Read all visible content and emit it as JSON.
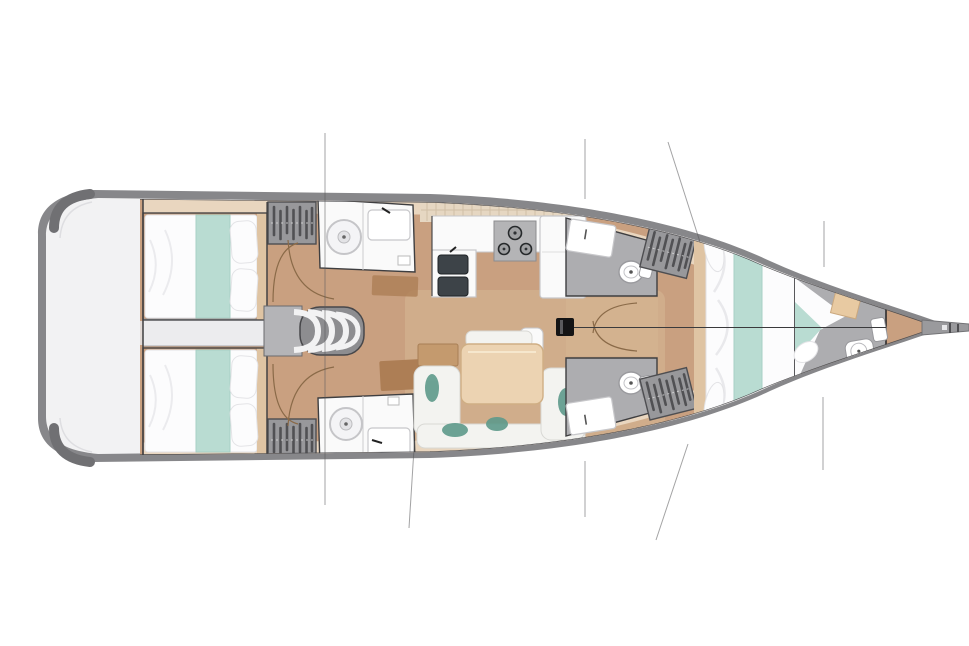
{
  "diagram": {
    "type": "floor-plan",
    "title": "Sailing yacht interior layout plan — top view, bow to the right",
    "areas": {
      "stern_platform": "Stern swim platform",
      "aft_cabin_port": "Aft cabin port side — double berth",
      "aft_cabin_starboard": "Aft cabin starboard side — double berth",
      "corridor": "Aft corridor between cabins",
      "companionway": "Companionway steps",
      "aft_head_port": "Aft head port — shower and sink",
      "aft_head_starboard": "Aft head starboard — shower and sink",
      "chart_table": "Chart table",
      "galley": "Galley — stove, double sink and counters",
      "saloon": "Saloon — U-shaped settee with table",
      "mast": "Mast",
      "fwd_head_port": "Forward head port — toilet and sink",
      "fwd_head_starboard": "Forward head starboard — toilet and sink",
      "fwd_cabin": "Forward cabin — V-berth",
      "forepeak": "Forepeak head compartment",
      "bowsprit": "Bowsprit",
      "wardrobe": "Hanging locker",
      "rigging": "Rigging lines",
      "centerline": "Hull centerline"
    }
  },
  "colors": {
    "hull_edge": "#87878a",
    "hull_corner": "#707073",
    "deck": "#f2f2f3",
    "floor_wood": "#c9a080",
    "floor_wood_light": "#d8b996",
    "side_deck": "#e9d6bf",
    "tile": "#e6d7c2",
    "tile_line": "#d0bfa6",
    "wall": "#3e3e40",
    "white_furniture": "#fafafa",
    "furniture_stroke": "#c7c7ca",
    "bed_white": "#fcfcfd",
    "teal_light": "#b9dcd2",
    "teal_dark": "#5e9a8b",
    "table_wood": "#ecd3b2",
    "desk_wood": "#ad7e55",
    "shelf_wood": "#dfc4a3",
    "wardrobe_gray": "#98989b",
    "wardrobe_stripe": "#515154",
    "gray_floor": "#adadb0",
    "landing_gray": "#b4b4b7",
    "stairs_frame": "#8d8d90",
    "stove_gray": "#b4b4b6",
    "burner_dark": "#2e3134",
    "sink_dark": "#3d4348",
    "mast_black": "#141415",
    "rigging": "#58585a",
    "door_arc": "#8a6a48",
    "centerline": "#3a3a3c",
    "corridor": "#ececee",
    "bow_sprit": "#9a9a9d"
  }
}
